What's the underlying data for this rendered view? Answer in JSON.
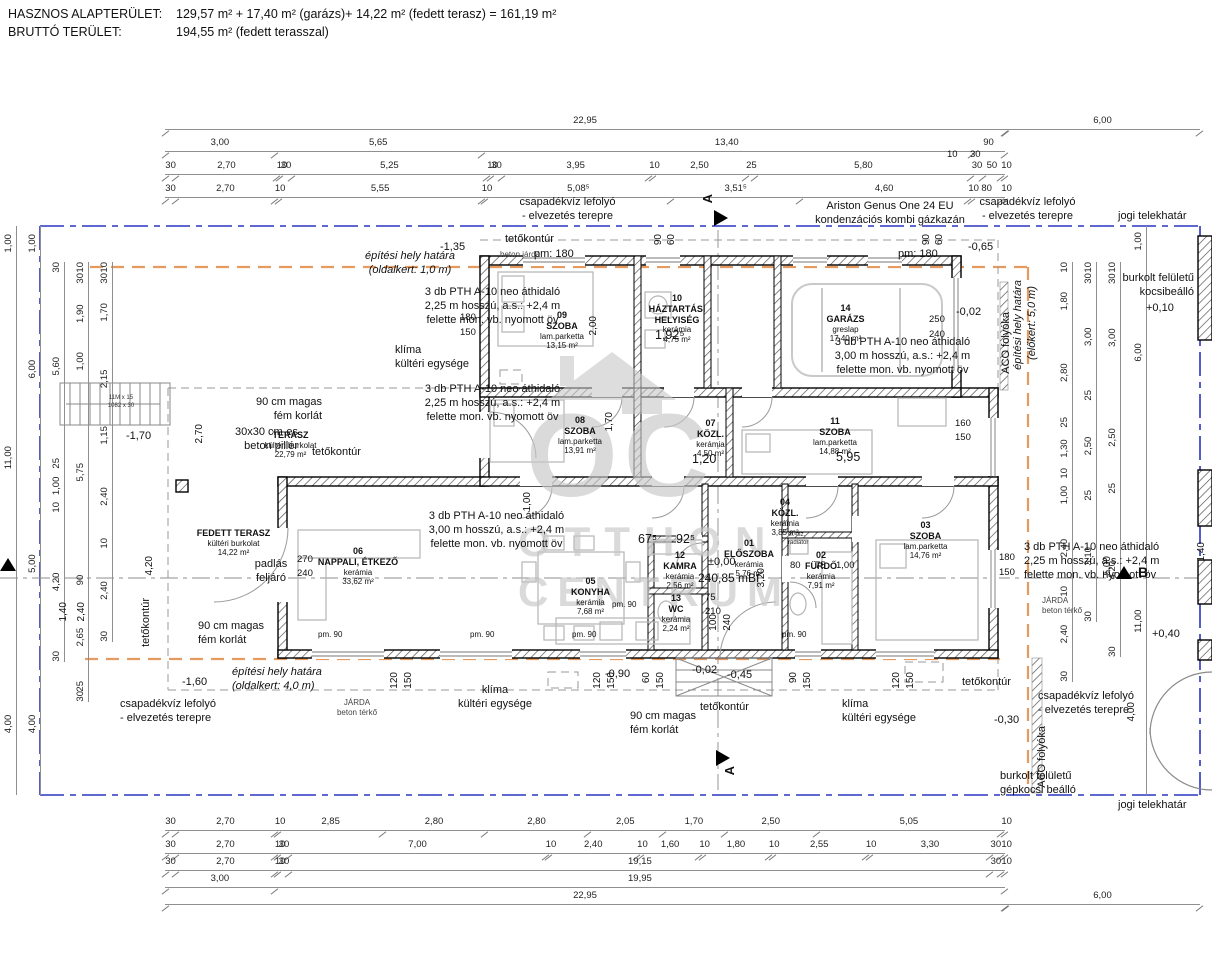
{
  "header": {
    "line1_label": "HASZNOS ALAPTERÜLET:",
    "line1_value": "129,57 m² + 17,40 m² (garázs)+  14,22 m² (fedett terasz) = 161,19 m²",
    "line2_label": "BRUTTÓ TERÜLET:",
    "line2_value": "194,55 m² (fedett terasszal)"
  },
  "watermark": {
    "letters": "OC",
    "line1": "OTTHON",
    "line2": "CENTRUM"
  },
  "colors": {
    "boundary_blue": "#2a35c0",
    "site_orange": "#e59a5f",
    "wall_black": "#000000",
    "furniture_gray": "#b5b5b5",
    "watermark_gray": "#c7c7c7"
  },
  "rooms": [
    {
      "num": "01",
      "name": "ELŐSZOBA",
      "mat": "kerámia",
      "area": "5,76 m²"
    },
    {
      "num": "02",
      "name": "FÜRDŐ",
      "mat": "kerámia",
      "area": "7,91 m²"
    },
    {
      "num": "03",
      "name": "SZOBA",
      "mat": "lam.parketta",
      "area": "14,76 m²"
    },
    {
      "num": "04",
      "name": "KÖZL.",
      "mat": "kerámia",
      "area": "3,85 m²"
    },
    {
      "num": "05",
      "name": "KONYHA",
      "mat": "kerámia",
      "area": "7,68 m²"
    },
    {
      "num": "06",
      "name": "NAPPALI, ÉTKEZŐ",
      "mat": "kerámia",
      "area": "33,62 m²"
    },
    {
      "num": "07",
      "name": "KÖZL.",
      "mat": "kerámia",
      "area": "4,50 m²"
    },
    {
      "num": "08",
      "name": "SZOBA",
      "mat": "lam.parketta",
      "area": "13,91 m²"
    },
    {
      "num": "09",
      "name": "SZOBA",
      "mat": "lam.parketta",
      "area": "13,15 m²"
    },
    {
      "num": "10",
      "name": "HÁZTARTÁSI HELYISÉG",
      "mat": "kerámia",
      "area": "4,75 m²"
    },
    {
      "num": "11",
      "name": "SZOBA",
      "mat": "lam.parketta",
      "area": "14,88 m²"
    },
    {
      "num": "12",
      "name": "KAMRA",
      "mat": "kerámia",
      "area": "2,56 m²"
    },
    {
      "num": "13",
      "name": "WC",
      "mat": "kerámia",
      "area": "2,24 m²"
    },
    {
      "num": "14",
      "name": "GARÁZS",
      "mat": "greslap",
      "area": "17,40 m²"
    },
    {
      "num": "",
      "name": "TERASZ",
      "mat": "kültéri burkolat",
      "area": "22,79 m²"
    },
    {
      "num": "",
      "name": "FEDETT TERASZ",
      "mat": "kültéri burkolat",
      "area": "14,22 m²"
    }
  ],
  "dims": {
    "top": {
      "row1": [
        "22,95"
      ],
      "row2": [
        "3,00",
        "5,65",
        "13,40",
        "90"
      ],
      "row3": [
        "30",
        "2,70",
        "10",
        "30",
        "5,25",
        "10",
        "30",
        "3,95",
        "10",
        "2,50",
        "25",
        "5,80",
        "30",
        "50",
        "10"
      ],
      "row4": [
        "30",
        "2,70",
        "10",
        "5,55",
        "10",
        "5,08⁵",
        "3,51⁵",
        "4,60",
        "10",
        "80",
        "10"
      ],
      "six": "6,00",
      "ov10": "10",
      "ov30": "30"
    },
    "bottom": {
      "row1": [
        "30",
        "2,70",
        "10",
        "2,85",
        "2,80",
        "2,80",
        "2,05",
        "1,70",
        "2,50",
        "5,05",
        "10"
      ],
      "row2": [
        "30",
        "2,70",
        "10",
        "30",
        "7,00",
        "10",
        "2,40",
        "10",
        "1,60",
        "10",
        "1,80",
        "10",
        "2,55",
        "10",
        "3,30",
        "30",
        "10"
      ],
      "row3": [
        "30",
        "2,70",
        "10",
        "30",
        "19,15",
        "30",
        "10"
      ],
      "row4": [
        "3,00",
        "19,95"
      ],
      "row5": [
        "22,95"
      ],
      "six": "6,00"
    },
    "left": {
      "col1": [
        "1,00",
        "11,00",
        "4,00"
      ],
      "col2": [
        "1,00",
        "6,00",
        "5,00",
        "4,00"
      ],
      "col3": [
        "30",
        "5,60",
        "25",
        "1,00",
        "10",
        "4,20",
        "30"
      ],
      "col4": [
        "10",
        "30",
        "1,90",
        "1,00",
        "5,75",
        "90",
        "2,65",
        "25",
        "30"
      ],
      "col5": [
        "10",
        "30",
        "1,70",
        "2,15",
        "1,15",
        "2,40",
        "10",
        "2,40",
        "30"
      ]
    },
    "right": {
      "col1": [
        "10",
        "1,80",
        "2,80",
        "25",
        "1,30",
        "10",
        "1,00",
        "2,40",
        "10",
        "2,40",
        "30"
      ],
      "col2": [
        "10",
        "30",
        "3,00",
        "25",
        "2,50",
        "25",
        "3,10",
        "30"
      ],
      "col3": [
        "10",
        "30",
        "3,00",
        "2,50",
        "25",
        "4,20",
        "30"
      ],
      "col4": [
        "1,00",
        "6,00",
        "11,00"
      ]
    }
  },
  "ann": {
    "csap1": "csapadékvíz lefolyó",
    "csap2": "- elvezetés terepre",
    "jogi": "jogi telekhatár",
    "teto": "tetőkontúr",
    "ariston1": "Ariston Genus One 24 EU",
    "ariston2": "kondenzációs kombi gázkazán",
    "eph": "építési hely határa",
    "eph1": "(oldalkert: 1,0 m)",
    "eph4": "(oldalkert: 4,0 m)",
    "eph5": "(előkert: 5,0 m)",
    "pth": "3 db PTH A-10 neo áthidaló",
    "pth225": "2,25 m hosszú, a.s.: +2,4 m",
    "pth300": "3,00 m hosszú, a.s.: +2,4 m",
    "pthov": "felette mon. vb. nyomott öv",
    "klima1": "klíma",
    "klima2": "kültéri egysége",
    "korlat1": "90 cm magas",
    "korlat2": "fém korlát",
    "pillar1": "30x30 cm-es",
    "pillar2": "beton pillér",
    "padlas1": "padlás",
    "padlas2": "feljáró",
    "betonjarda": "beton járda",
    "jarda1": "JÁRDA",
    "jarda2": "beton térkő",
    "aco": "ACO folyóka",
    "burk1": "burkolt felületű",
    "burk2": "kocsibeálló",
    "burk3": "gépkocsi beálló",
    "radiator1": "el. fsz.",
    "radiator2": "radiátor",
    "stair1": "11M x 15",
    "stair2": "1082 x 30",
    "secA": "A",
    "secB": "B",
    "pm180": "pm: 180",
    "pm90": "pm. 90"
  },
  "levels": {
    "p010": "+0,10",
    "p040": "+0,40",
    "zero": "±0,00",
    "mbf": "240,85 mBf",
    "m002": "-0,02",
    "m030": "-0,30",
    "m045": "-0,45",
    "m065": "-0,65",
    "m090": "-0,90",
    "m135": "-1,35",
    "m160": "-1,60",
    "m170": "-1,70"
  },
  "pd": {
    "d200": "2,00",
    "d1925": "1,92⁵",
    "d170": "1,70",
    "d120": "1,20",
    "d595": "5,95",
    "d320": "3,20",
    "d675": "67⁵",
    "d925": "92⁵",
    "d100": "1,00",
    "d270m": "2,70",
    "d420m": "4,20",
    "d500": "5,00",
    "d400": "4,00",
    "d140": "1,40",
    "d240m": "2,40",
    "n60": "60",
    "n75": "75",
    "n80": "80",
    "n90": "90",
    "n100": "100",
    "n120": "120",
    "n150": "150",
    "n160": "160",
    "n180": "180",
    "n210": "210",
    "n240": "240",
    "n250": "250",
    "n270": "270"
  }
}
